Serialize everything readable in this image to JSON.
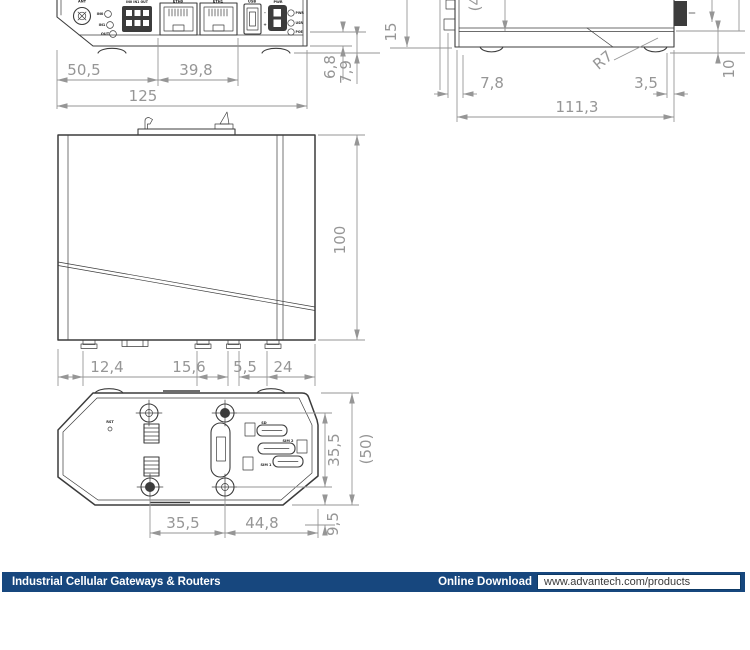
{
  "colors": {
    "footer_navy": "#17477e",
    "line": "#3c3c3c",
    "dim": "#969696",
    "label": "#222222"
  },
  "footer": {
    "series_title": "Industrial Cellular Gateways & Routers",
    "download_label": "Online Download",
    "download_url": "www.advantech.com/products"
  },
  "front_panel_view": {
    "ant_label": "ANT",
    "io_header": "IN0 IN1 OUT",
    "io_labels": [
      "IN0",
      "IN1",
      "OUT"
    ],
    "eth0_label": "ETH0",
    "eth1_label": "ETH1",
    "usb_label": "USB",
    "pwr_label": "PWR",
    "pwr_minus": "-",
    "pwr_plus": "+",
    "led_labels": [
      "PWR",
      "USR",
      "POE"
    ],
    "dims": {
      "left_section": "50,5",
      "eth_section": "39,8",
      "total_width": "125",
      "edge_offset_a": "6,8",
      "edge_offset_b": "7,9"
    }
  },
  "side_view": {
    "dims": {
      "height_ref": "(45)",
      "top_offset": "15",
      "foot_offset_left": "7,8",
      "corner_radius": "R7",
      "foot_offset_right": "3,5",
      "bottom_band": "10",
      "total_depth": "111,3"
    }
  },
  "main_view": {
    "dims": {
      "foot_1": "12,4",
      "foot_2": "15,6",
      "foot_3": "5,5",
      "foot_4": "24",
      "total_height": "100"
    }
  },
  "bottom_view": {
    "rst_label": "RST",
    "slot_labels": [
      "SD",
      "SIM 2",
      "SIM 1"
    ],
    "dims": {
      "screw_span_v": "35,5",
      "depth_ref": "(50)",
      "screw_span_h": "35,5",
      "screw_to_edge": "44,8",
      "edge_offset": "9,5"
    }
  }
}
